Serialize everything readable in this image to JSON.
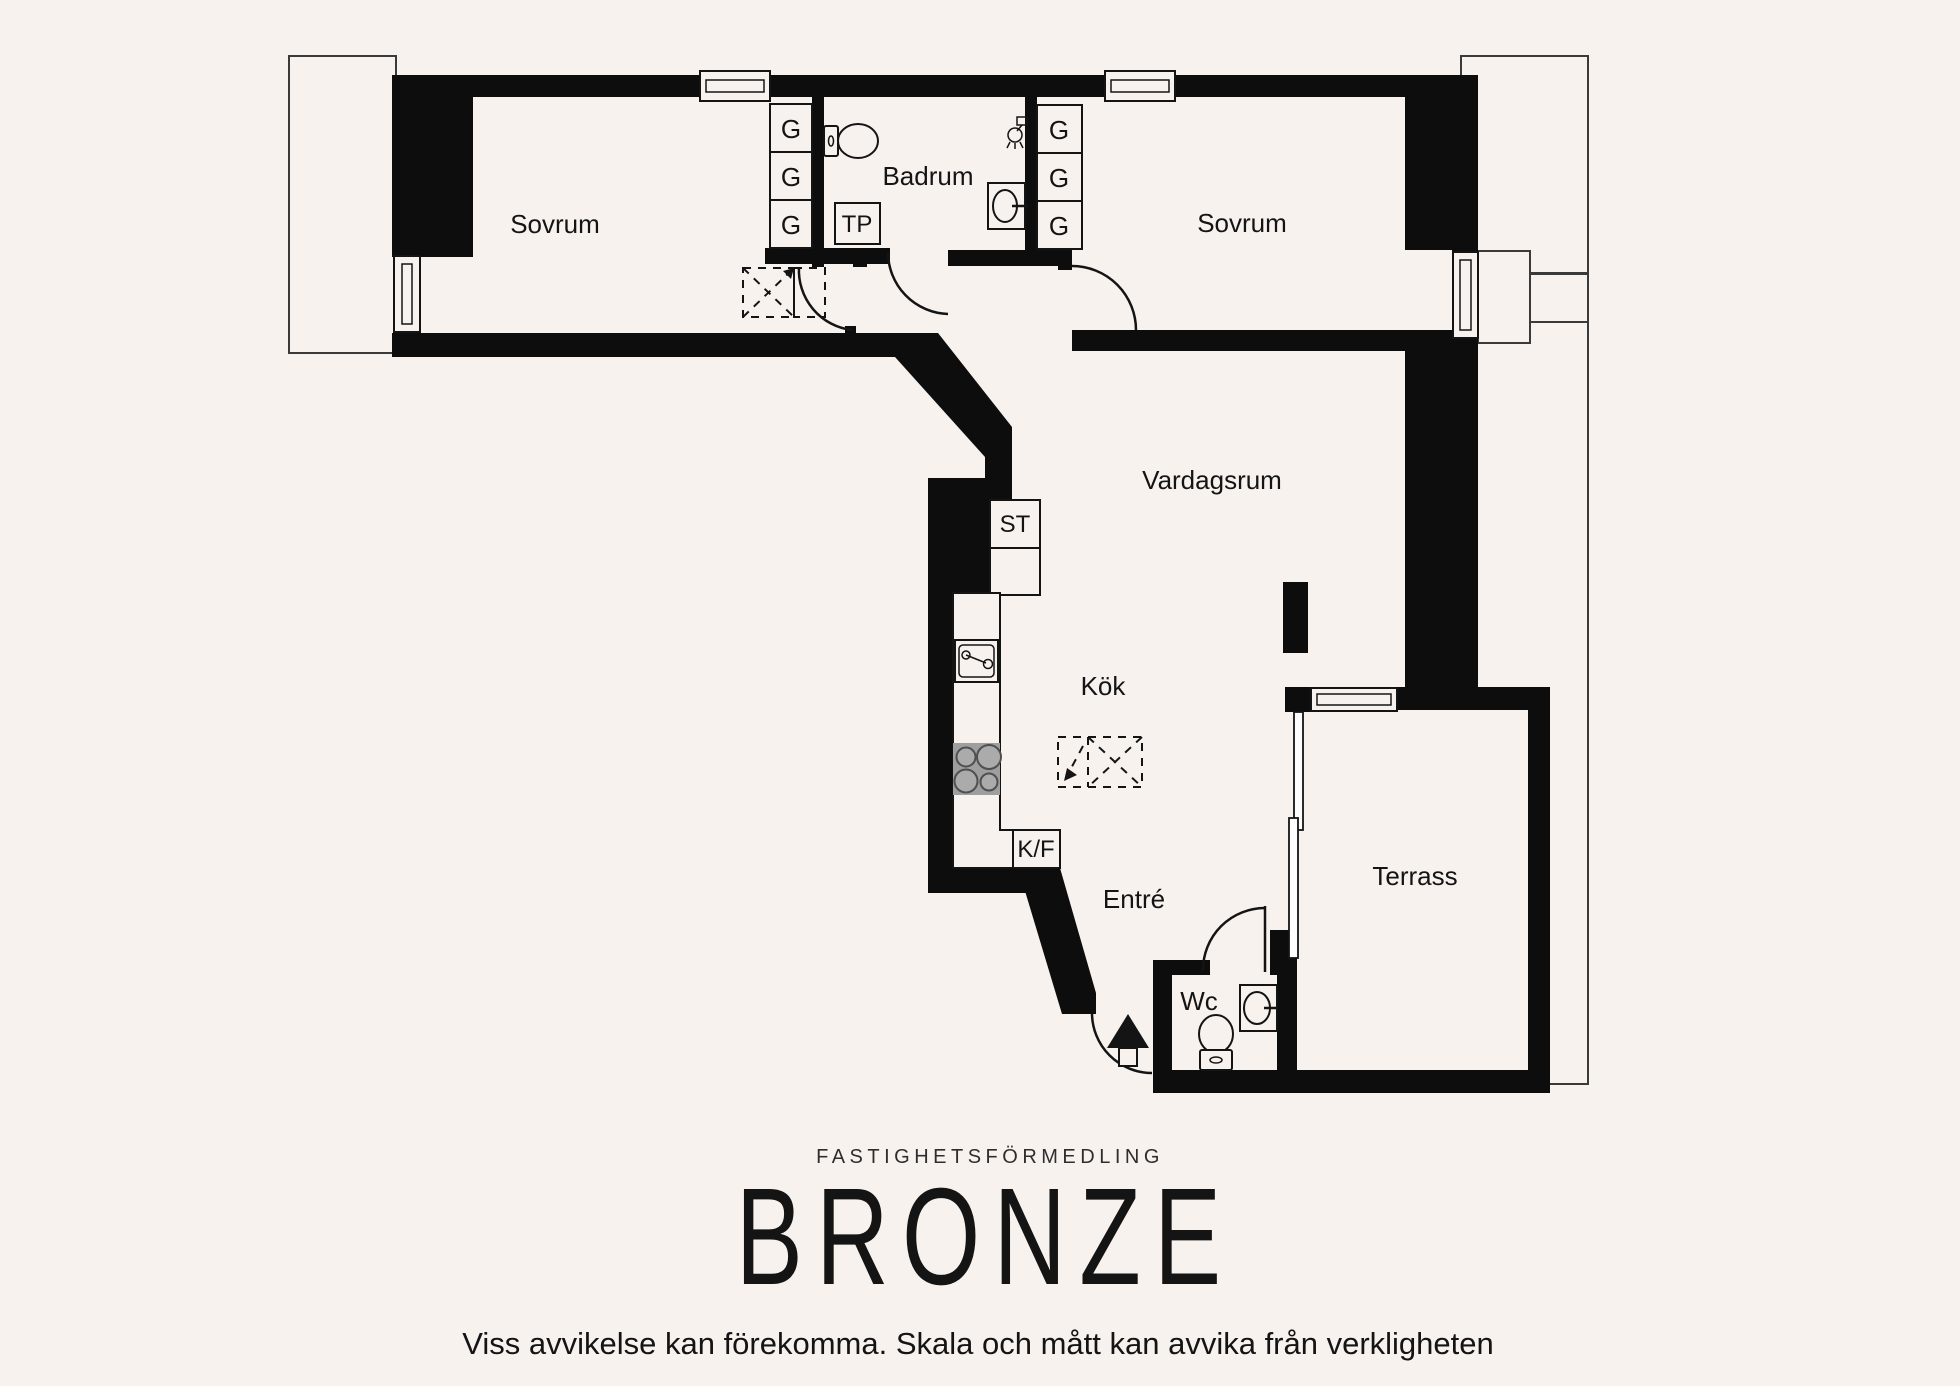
{
  "plan": {
    "room_labels": {
      "bedroom_left": "Sovrum",
      "bathroom": "Badrum",
      "bedroom_right": "Sovrum",
      "living_room": "Vardagsrum",
      "kitchen": "Kök",
      "entry": "Entré",
      "wc": "Wc",
      "terrace": "Terrass"
    },
    "fixture_labels": {
      "wardrobe": "G",
      "toilet_paper_holder": "TP",
      "cleaning_cabinet": "ST",
      "fridge_freezer": "K/F"
    }
  },
  "footer": {
    "company_type": "FASTIGHETSFÖRMEDLING",
    "brand": "BRONZE",
    "disclaimer": "Viss avvikelse kan förekomma. Skala och mått kan avvika från verkligheten"
  },
  "colors": {
    "background": "#f8f2ef",
    "wall": "#0d0d0d",
    "line": "#141414",
    "outline": "#3a3a3a",
    "stove-body": "#9e9e9e",
    "stove-burner": "#4f4f4f"
  }
}
